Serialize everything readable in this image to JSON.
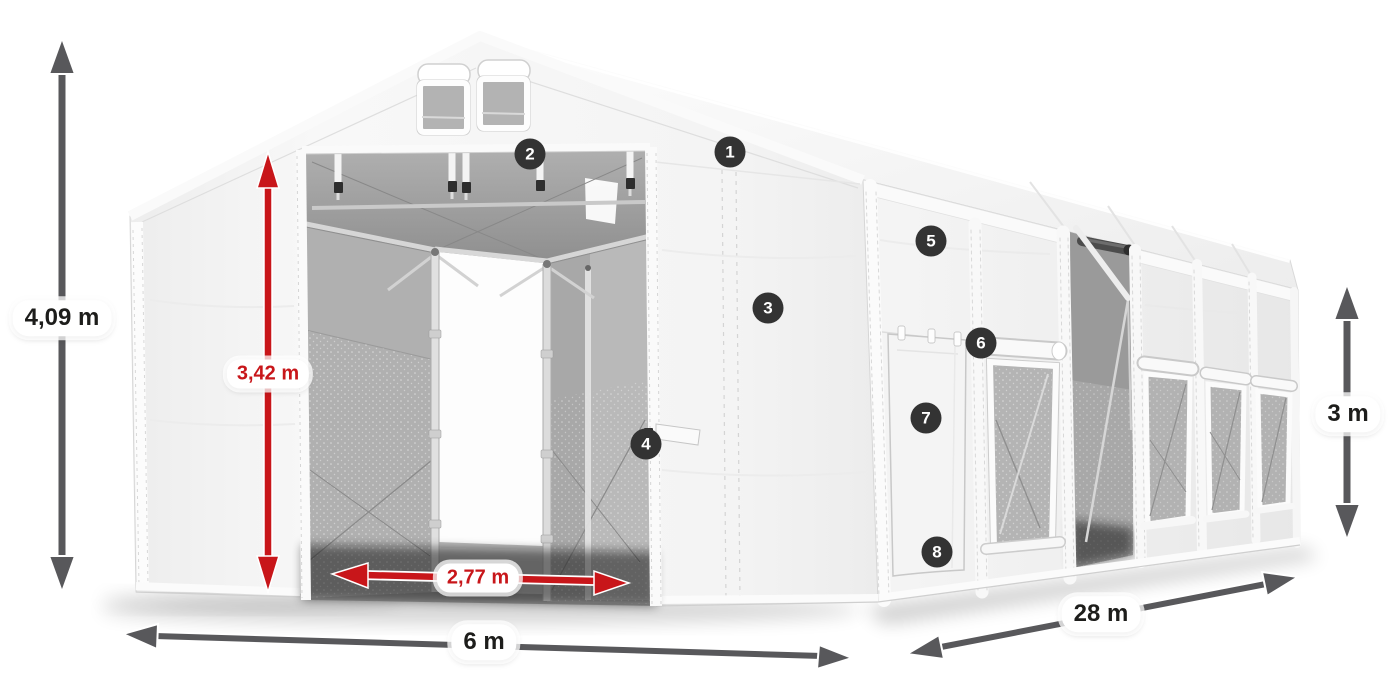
{
  "scene": {
    "type": "product-dimension-diagram",
    "subject": "white marquee storage tent with open entrance and side windows"
  },
  "colors": {
    "dimension_arrow_gray": "#58585b",
    "dimension_arrow_red": "#c8161a",
    "badge_background": "#333333",
    "badge_number": "#ffffff",
    "label_text": "#1d1d1b",
    "label_background": "#ffffff"
  },
  "dimension_labels": {
    "total_height": "4,09 m",
    "entrance_height": "3,42 m",
    "entrance_width": "2,77 m",
    "tent_width": "6 m",
    "tent_length": "28 m",
    "side_height": "3 m"
  },
  "feature_badges": [
    {
      "number": "1"
    },
    {
      "number": "2"
    },
    {
      "number": "3"
    },
    {
      "number": "4"
    },
    {
      "number": "5"
    },
    {
      "number": "6"
    },
    {
      "number": "7"
    },
    {
      "number": "8"
    }
  ]
}
